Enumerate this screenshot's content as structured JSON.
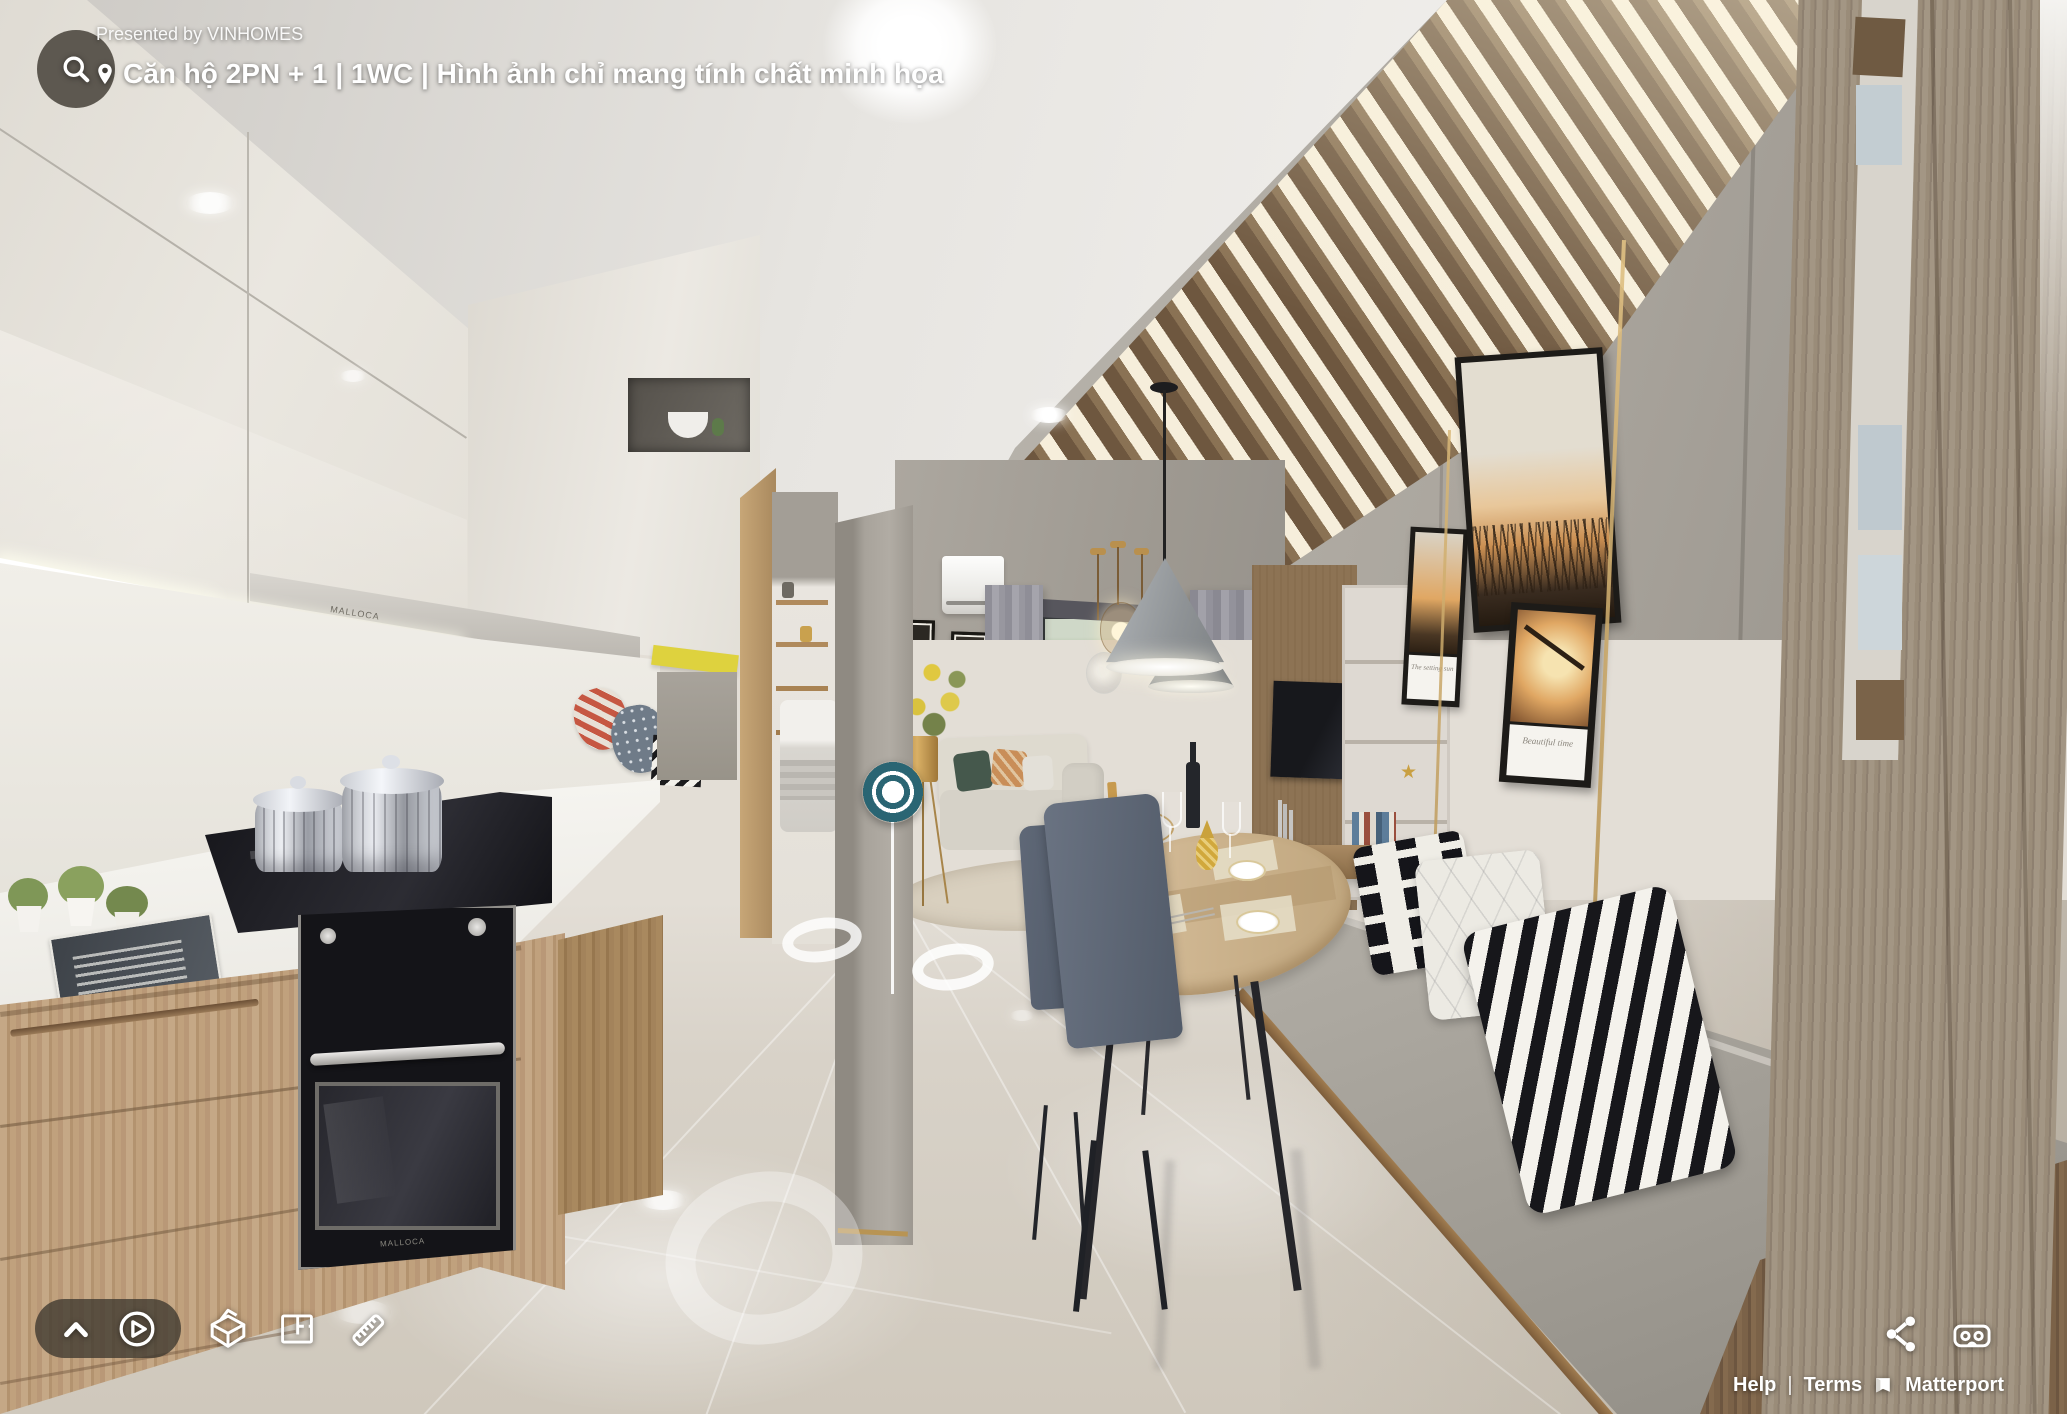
{
  "header": {
    "presented_by": "Presented by VINHOMES",
    "location_title": "Căn hộ 2PN + 1 | 1WC | Hình ảnh chỉ mang tính chất minh họa"
  },
  "controls": {
    "left": [
      {
        "id": "expand",
        "icon": "chevron-up-icon"
      },
      {
        "id": "play",
        "icon": "play-circle-icon"
      },
      {
        "id": "dollhouse",
        "icon": "dollhouse-icon"
      },
      {
        "id": "floorplan",
        "icon": "floorplan-icon"
      },
      {
        "id": "measure",
        "icon": "ruler-icon"
      }
    ],
    "right": [
      {
        "id": "share",
        "icon": "share-icon"
      },
      {
        "id": "vr",
        "icon": "vr-headset-icon"
      }
    ]
  },
  "footer": {
    "help": "Help",
    "separator": "|",
    "terms": "Terms",
    "brand": "Matterport"
  },
  "scene": {
    "appliance_brand": "MALLOCA",
    "pictures": {
      "caption_small": "The setting sun",
      "caption_medium": "Beautiful time"
    },
    "colors": {
      "accent_teal": "#2a6573",
      "nav_ring_white": "rgba(255,255,255,0.8)",
      "ui_pill": "rgba(62,56,48,0.78)"
    }
  }
}
